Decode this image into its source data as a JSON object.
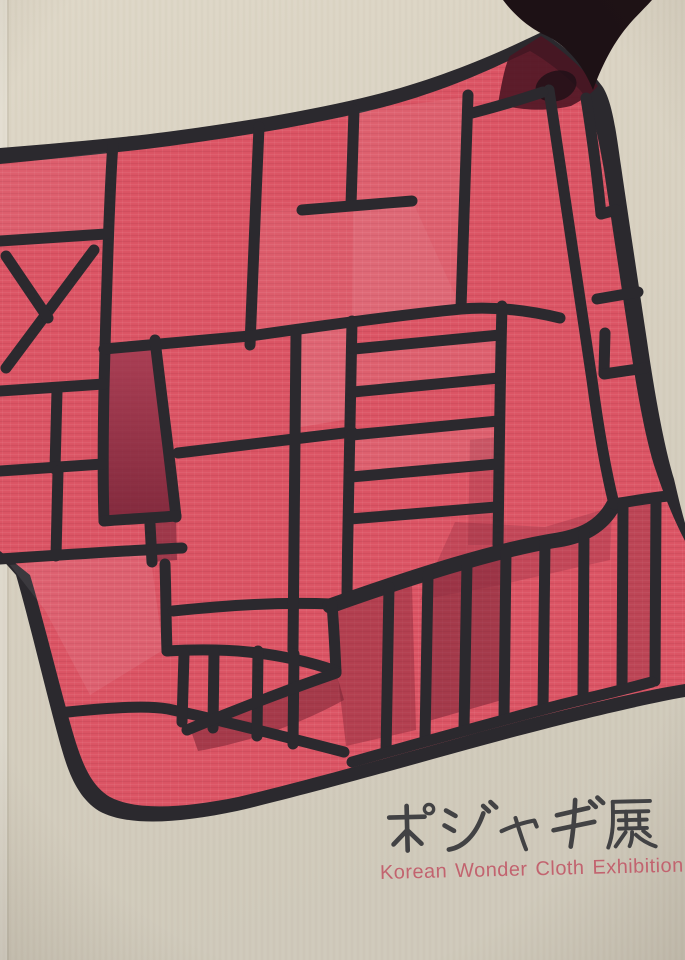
{
  "cover": {
    "title_ja": "ポジャギ展",
    "subtitle_en": "Korean Wonder Cloth Exhibition",
    "artwork_alt": "Red pojagi patchwork wrapping cloth painted in red patches with black seam lines on cream paper"
  },
  "colors": {
    "paper": "#d8d1c0",
    "paper_deep": "#cdc6b5",
    "cloth_red": "#dc5565",
    "cloth_red_light": "#e6747f",
    "cloth_red_dark": "#9e3950",
    "cloth_maroon": "#6d2034",
    "line": "#2b292e",
    "ink_black": "#1d1115",
    "title_text": "#424244",
    "subtitle_text": "#c2636f"
  }
}
